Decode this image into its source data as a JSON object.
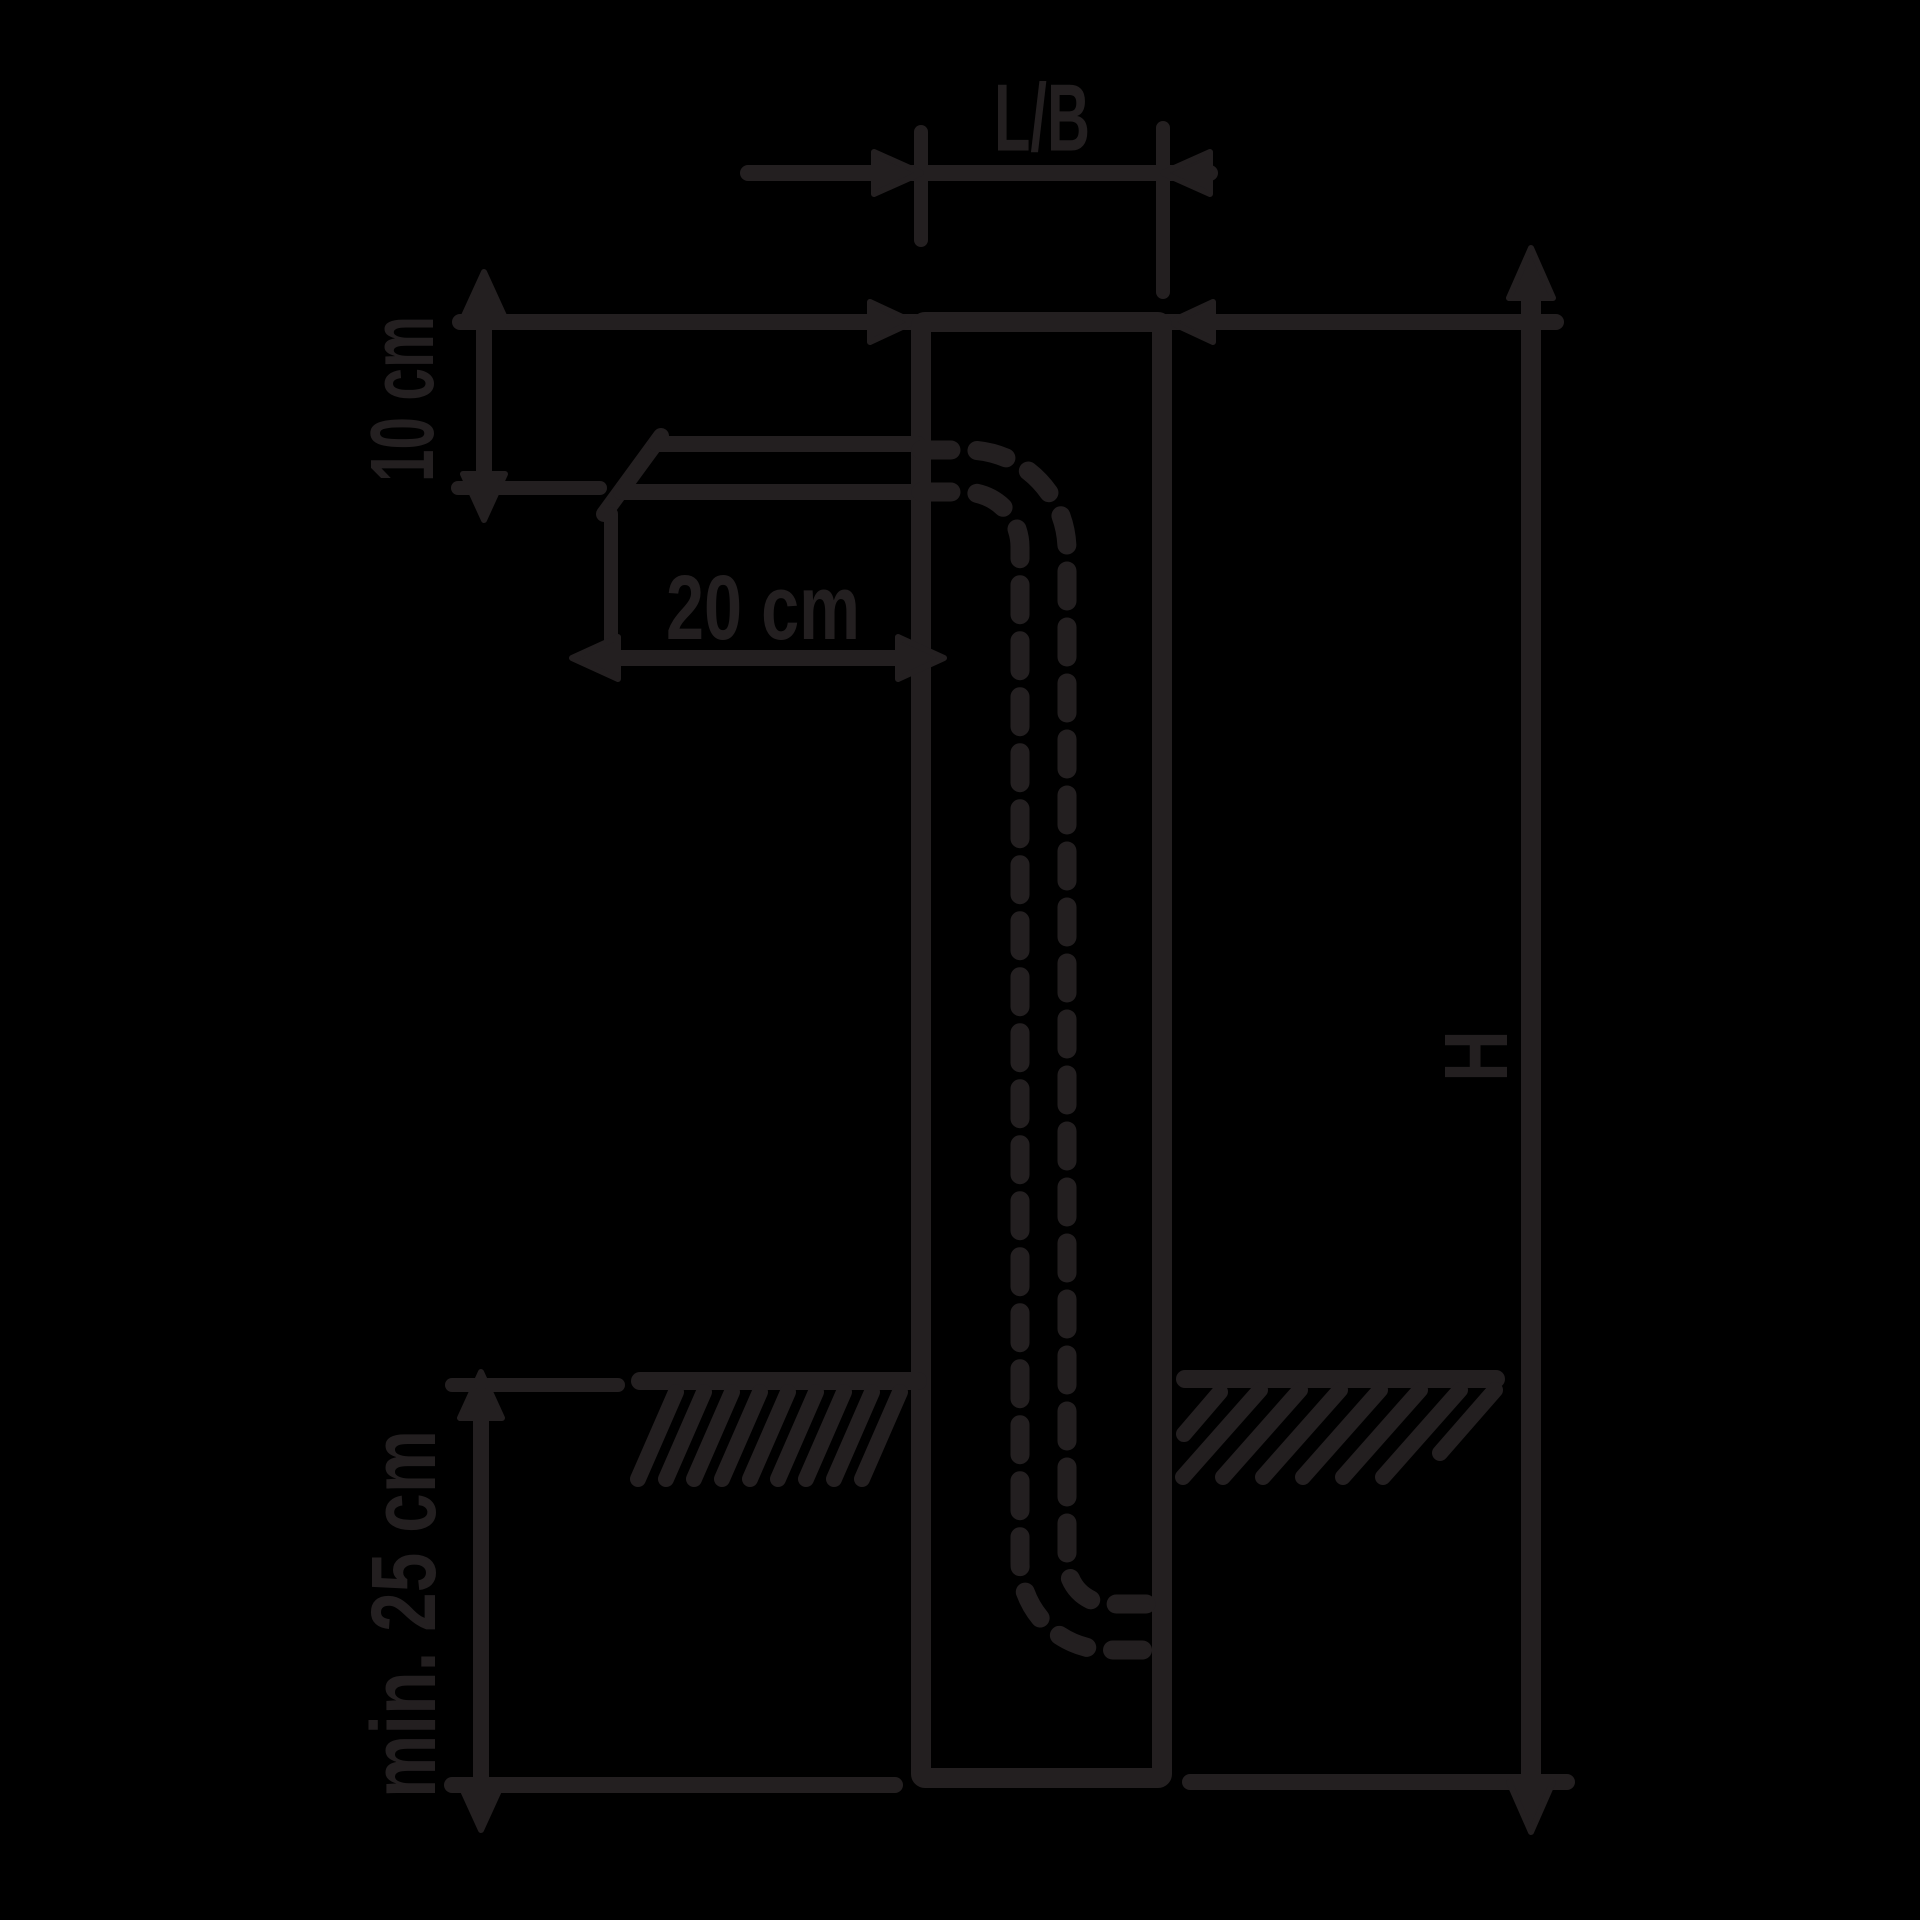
{
  "diagram": {
    "kind": "post-installation-dimension-drawing",
    "colors": {
      "background": "#000000",
      "line": "#231f20"
    },
    "labels": {
      "post_width": "L/B",
      "cable_depth_from_top": "10 cm",
      "cable_horizontal_offset": "20 cm",
      "foundation_depth": "min. 25 cm",
      "post_height": "H"
    },
    "components": [
      "post-outline",
      "cable-conduit-solid",
      "cable-conduit-hidden-dashed",
      "ground-line-with-hatching",
      "dimension-lines-with-arrows"
    ]
  }
}
